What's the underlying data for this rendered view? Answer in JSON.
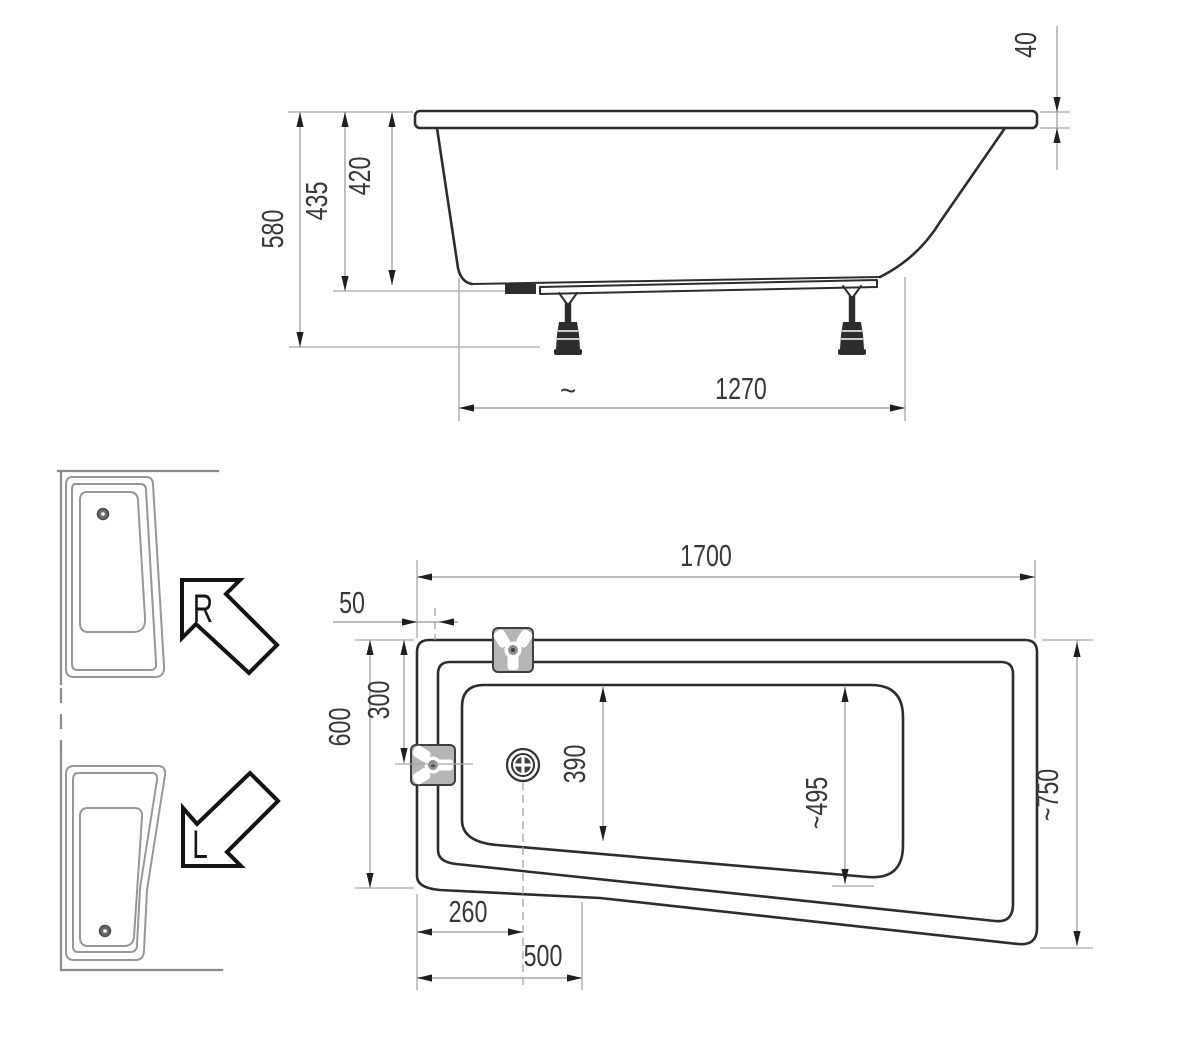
{
  "drawing": {
    "side_view": {
      "rim_height": "40",
      "total_height": "580",
      "shell_height": "435",
      "inner_depth": "420",
      "support_span": "1270",
      "approx": "~"
    },
    "plan_view": {
      "length": "1700",
      "rim_width": "50",
      "left_width": "600",
      "fitting_offset": "300",
      "bowl_width": "390",
      "bowl_width_right": "~495",
      "right_width": "~750",
      "drain_offset": "260",
      "taper_offset": "500"
    },
    "orientation": {
      "right": "R",
      "left": "L"
    },
    "colors": {
      "line": "#2d2d2d",
      "dimension": "#a6a6a6",
      "text": "#383838",
      "fitting_fill": "#b5b5b5"
    }
  }
}
